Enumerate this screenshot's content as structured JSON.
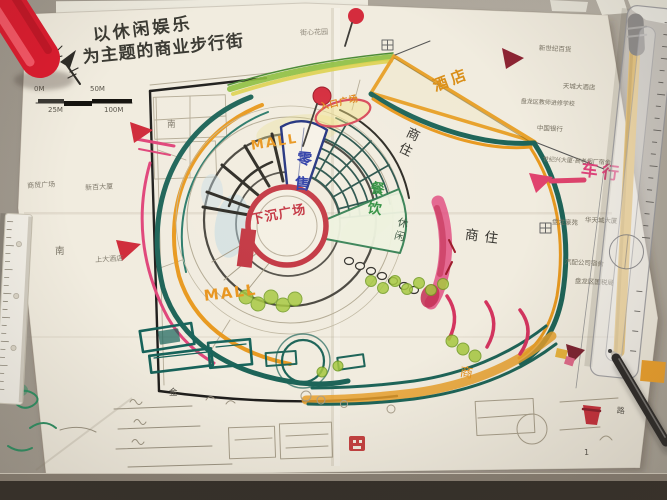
{
  "photo": {
    "scene": "hand-drawn master plan of a commercial pedestrian street on a desk"
  },
  "title": {
    "line1": "以休闲娱乐",
    "line2": "为主题的商业步行街"
  },
  "scale_bar": {
    "top_labels": [
      "0M",
      "50M"
    ],
    "bottom_labels": [
      "25M",
      "100M"
    ]
  },
  "plan": {
    "mall_upper": "MALL",
    "mall_lower": "MALL",
    "hotel": "酒店",
    "retail": "零售",
    "sunken_plaza": "下沉广场",
    "dining": "餐饮",
    "leisure": "休闲",
    "mixed_use_upper": "商住",
    "mixed_use_right": "商住",
    "entrance_plaza": "入口广场",
    "commercial": "商",
    "vehicle_flow": "车行",
    "south": "南",
    "gold": "金",
    "road": "路",
    "page_number": "1"
  },
  "surroundings": {
    "top": "街心花园",
    "left": [
      "商贸广场",
      "新百大厦",
      "上大酒店"
    ],
    "right": [
      "新世纪百货",
      "天城大酒店",
      "盘龙区教师进修学校",
      "中国银行",
      "世纪兴大厦·高老烟厂宿舍",
      "盘龙豪苑",
      "华天城大厦",
      "汽配公司宿舍",
      "盘龙区国税局"
    ]
  },
  "colors": {
    "accent_pink": "#e0457a",
    "accent_orange": "#e8991f",
    "accent_teal": "#1d6458",
    "accent_red": "#c23440",
    "accent_blue": "#2636a8",
    "accent_green": "#36923c"
  }
}
